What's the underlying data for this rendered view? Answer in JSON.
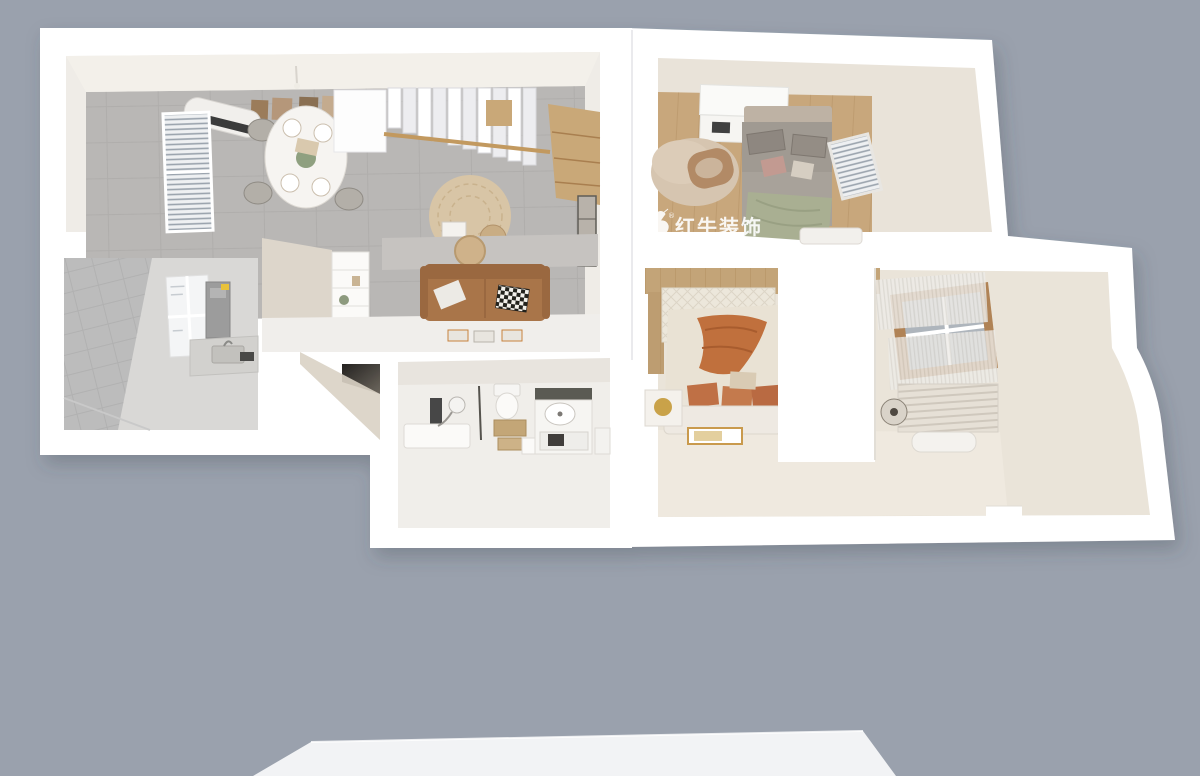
{
  "watermark": {
    "brand": "红牛装饰",
    "registered": "®",
    "tagline": "HONG NIU DECORATION"
  },
  "palette": {
    "background": "#9aa1ad",
    "wall": "#ffffff",
    "floor-tile": "#b9b7b5",
    "floor-kitchen": "#d9d8d6",
    "floor-bath": "#f0eeea",
    "floor-wood": "#c8a77c",
    "floor-cream": "#eae4d9",
    "platform": "#f2f3f5",
    "stair-wood": "#c9a878",
    "sofa-leather": "#a9744a",
    "accent-throw": "#c0703c",
    "bed-gray": "#a09a92",
    "throw-green": "#a9af92",
    "watermark": "#ffffff"
  }
}
